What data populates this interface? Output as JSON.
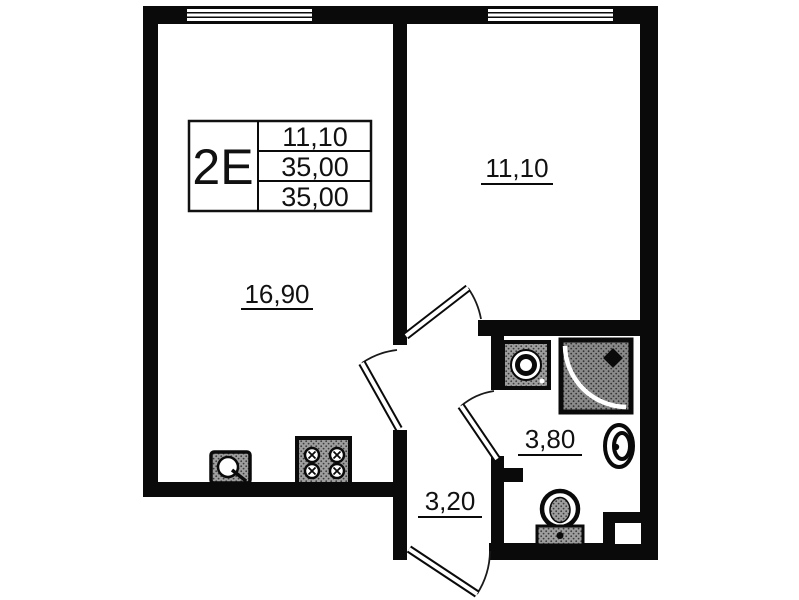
{
  "title": "apartment floor plan 2E",
  "info_box": {
    "type": "2E",
    "values": [
      "11,10",
      "35,00",
      "35,00"
    ]
  },
  "rooms": {
    "living": {
      "area": "16,90"
    },
    "bedroom": {
      "area": "11,10"
    },
    "bathroom": {
      "area": "3,80"
    },
    "hallway": {
      "area": "3,20"
    }
  },
  "colors": {
    "wall": "#0a0a0a",
    "background": "#ffffff",
    "fixture_fill": "#9e9e9e",
    "fixture_dot": "#3c3c3c",
    "shower_fill": "#8a8a8a",
    "text": "#111111"
  }
}
